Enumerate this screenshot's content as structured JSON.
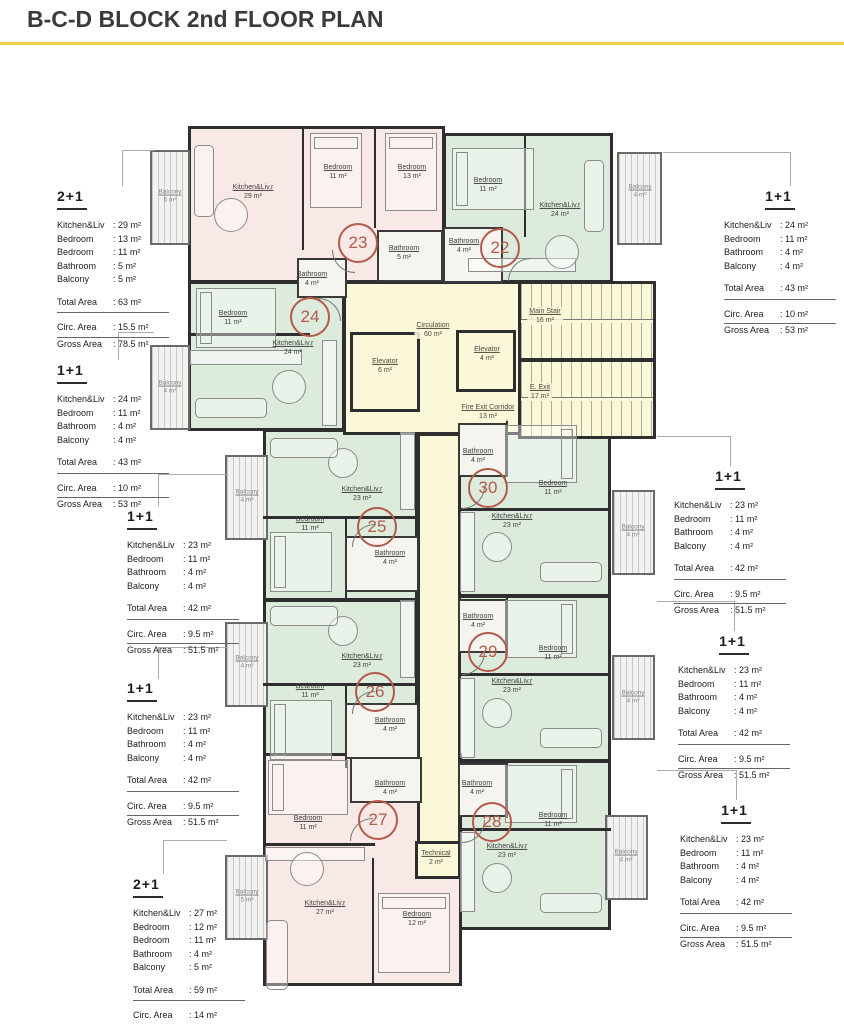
{
  "title": "B-C-D BLOCK 2nd FLOOR PLAN",
  "colors": {
    "accent_line": "#e9d44c",
    "unit_pink": "#f9e9e6",
    "unit_green": "#dcebdb",
    "core_cream": "#fbf7d9",
    "unit_number_circle": "#b45a4b",
    "wall": "#2e2e2e"
  },
  "spec_boxes": {
    "left": [
      {
        "type": "2+1",
        "items": [
          {
            "label": "Kitchen&Liv",
            "value": ": 29 m²"
          },
          {
            "label": "Bedroom",
            "value": ": 13 m²"
          },
          {
            "label": "Bedroom",
            "value": ": 11 m²"
          },
          {
            "label": "Bathroom",
            "value": ": 5 m²"
          },
          {
            "label": "Balcony",
            "value": ": 5 m²"
          }
        ],
        "total": {
          "label": "Total Area",
          "value": ": 63 m²"
        },
        "circ": {
          "label": "Circ. Area",
          "value": ": 15.5 m²"
        },
        "gross": {
          "label": "Gross Area",
          "value": ": 78.5 m²"
        }
      },
      {
        "type": "1+1",
        "items": [
          {
            "label": "Kitchen&Liv",
            "value": ": 24 m²"
          },
          {
            "label": "Bedroom",
            "value": ": 11 m²"
          },
          {
            "label": "Bathroom",
            "value": ": 4 m²"
          },
          {
            "label": "Balcony",
            "value": ": 4 m²"
          }
        ],
        "total": {
          "label": "Total Area",
          "value": ": 43 m²"
        },
        "circ": {
          "label": "Circ. Area",
          "value": ": 10 m²"
        },
        "gross": {
          "label": "Gross Area",
          "value": ": 53 m²"
        }
      },
      {
        "type": "1+1",
        "items": [
          {
            "label": "Kitchen&Liv",
            "value": ": 23 m²"
          },
          {
            "label": "Bedroom",
            "value": ": 11 m²"
          },
          {
            "label": "Bathroom",
            "value": ": 4 m²"
          },
          {
            "label": "Balcony",
            "value": ": 4 m²"
          }
        ],
        "total": {
          "label": "Total Area",
          "value": ": 42 m²"
        },
        "circ": {
          "label": "Circ. Area",
          "value": ": 9.5 m²"
        },
        "gross": {
          "label": "Gross Area",
          "value": ": 51.5 m²"
        }
      },
      {
        "type": "1+1",
        "items": [
          {
            "label": "Kitchen&Liv",
            "value": ": 23 m²"
          },
          {
            "label": "Bedroom",
            "value": ": 11 m²"
          },
          {
            "label": "Bathroom",
            "value": ": 4 m²"
          },
          {
            "label": "Balcony",
            "value": ": 4 m²"
          }
        ],
        "total": {
          "label": "Total Area",
          "value": ": 42 m²"
        },
        "circ": {
          "label": "Circ. Area",
          "value": ": 9.5 m²"
        },
        "gross": {
          "label": "Gross Area",
          "value": ": 51.5 m²"
        }
      },
      {
        "type": "2+1",
        "items": [
          {
            "label": "Kitchen&Liv",
            "value": ": 27 m²"
          },
          {
            "label": "Bedroom",
            "value": ": 12 m²"
          },
          {
            "label": "Bedroom",
            "value": ": 11 m²"
          },
          {
            "label": "Bathroom",
            "value": ": 4 m²"
          },
          {
            "label": "Balcony",
            "value": ": 5 m²"
          }
        ],
        "total": {
          "label": "Total Area",
          "value": ": 59 m²"
        },
        "circ": {
          "label": "Circ. Area",
          "value": ": 14 m²"
        },
        "gross": {
          "label": "Gross Area",
          "value": ": 73 m²"
        }
      }
    ],
    "right": [
      {
        "type": "1+1",
        "items": [
          {
            "label": "Kitchen&Liv",
            "value": ": 24 m²"
          },
          {
            "label": "Bedroom",
            "value": ": 11 m²"
          },
          {
            "label": "Bathroom",
            "value": ": 4 m²"
          },
          {
            "label": "Balcony",
            "value": ": 4 m²"
          }
        ],
        "total": {
          "label": "Total Area",
          "value": ": 43 m²"
        },
        "circ": {
          "label": "Circ. Area",
          "value": ": 10 m²"
        },
        "gross": {
          "label": "Gross Area",
          "value": ": 53 m²"
        }
      },
      {
        "type": "1+1",
        "items": [
          {
            "label": "Kitchen&Liv",
            "value": ": 23 m²"
          },
          {
            "label": "Bedroom",
            "value": ": 11 m²"
          },
          {
            "label": "Bathroom",
            "value": ": 4 m²"
          },
          {
            "label": "Balcony",
            "value": ": 4 m²"
          }
        ],
        "total": {
          "label": "Total Area",
          "value": ": 42 m²"
        },
        "circ": {
          "label": "Circ. Area",
          "value": ": 9.5 m²"
        },
        "gross": {
          "label": "Gross Area",
          "value": ": 51.5 m²"
        }
      },
      {
        "type": "1+1",
        "items": [
          {
            "label": "Kitchen&Liv",
            "value": ": 23 m²"
          },
          {
            "label": "Bedroom",
            "value": ": 11 m²"
          },
          {
            "label": "Bathroom",
            "value": ": 4 m²"
          },
          {
            "label": "Balcony",
            "value": ": 4 m²"
          }
        ],
        "total": {
          "label": "Total Area",
          "value": ": 42 m²"
        },
        "circ": {
          "label": "Circ. Area",
          "value": ": 9.5 m²"
        },
        "gross": {
          "label": "Gross Area",
          "value": ": 51.5 m²"
        }
      },
      {
        "type": "1+1",
        "items": [
          {
            "label": "Kitchen&Liv",
            "value": ": 23 m²"
          },
          {
            "label": "Bedroom",
            "value": ": 11 m²"
          },
          {
            "label": "Bathroom",
            "value": ": 4 m²"
          },
          {
            "label": "Balcony",
            "value": ": 4 m²"
          }
        ],
        "total": {
          "label": "Total Area",
          "value": ": 42 m²"
        },
        "circ": {
          "label": "Circ. Area",
          "value": ": 9.5 m²"
        },
        "gross": {
          "label": "Gross Area",
          "value": ": 51.5 m²"
        }
      }
    ]
  },
  "plan": {
    "units": [
      "22",
      "23",
      "24",
      "25",
      "26",
      "27",
      "28",
      "29",
      "30"
    ],
    "rooms": [
      {
        "name": "Kitchen&Liv.r",
        "area": "29 m²"
      },
      {
        "name": "Bedroom",
        "area": "11 m²"
      },
      {
        "name": "Bedroom",
        "area": "13 m²"
      },
      {
        "name": "Bathroom",
        "area": "5 m²"
      },
      {
        "name": "Bedroom",
        "area": "11 m²"
      },
      {
        "name": "Kitchen&Liv.r",
        "area": "24 m²"
      },
      {
        "name": "Bathroom",
        "area": "4 m²"
      },
      {
        "name": "Bedroom",
        "area": "11 m²"
      },
      {
        "name": "Bathroom",
        "area": "4 m²"
      },
      {
        "name": "Kitchen&Liv.r",
        "area": "24 m²"
      },
      {
        "name": "Kitchen&Liv.r",
        "area": "23 m²"
      },
      {
        "name": "Bedroom",
        "area": "11 m²"
      },
      {
        "name": "Bathroom",
        "area": "4 m²"
      },
      {
        "name": "Kitchen&Liv.r",
        "area": "23 m²"
      },
      {
        "name": "Bedroom",
        "area": "11 m²"
      },
      {
        "name": "Bathroom",
        "area": "4 m²"
      },
      {
        "name": "Bathroom",
        "area": "4 m²"
      },
      {
        "name": "Bedroom",
        "area": "11 m²"
      },
      {
        "name": "Kitchen&Liv.r",
        "area": "23 m²"
      },
      {
        "name": "Bathroom",
        "area": "4 m²"
      },
      {
        "name": "Bedroom",
        "area": "11 m²"
      },
      {
        "name": "Kitchen&Liv.r",
        "area": "23 m²"
      },
      {
        "name": "Bathroom",
        "area": "4 m²"
      },
      {
        "name": "Bedroom",
        "area": "11 m²"
      },
      {
        "name": "Kitchen&Liv.r",
        "area": "23 m²"
      },
      {
        "name": "Bedroom",
        "area": "11 m²"
      },
      {
        "name": "Bathroom",
        "area": "4 m²"
      },
      {
        "name": "Kitchen&Liv.r",
        "area": "27 m²"
      },
      {
        "name": "Bedroom",
        "area": "12 m²"
      }
    ],
    "core": {
      "circulation": {
        "name": "Circulation",
        "area": "60 m²"
      },
      "elevator1": {
        "name": "Elevator",
        "area": "6 m²"
      },
      "elevator2": {
        "name": "Elevator",
        "area": "4 m²"
      },
      "main_stair": {
        "name": "Main Stair",
        "area": "16 m²"
      },
      "e_exit": {
        "name": "E. Exit",
        "area": "17 m²"
      },
      "fire_exit": {
        "name": "Fire Exit Corridor",
        "area": "13 m²"
      },
      "technical": {
        "name": "Technical",
        "area": "2 m²"
      }
    },
    "balconies": [
      {
        "name": "Balcony",
        "area": "5 m²"
      },
      {
        "name": "Balcony",
        "area": "4 m²"
      },
      {
        "name": "Balcony",
        "area": "4 m²"
      },
      {
        "name": "Balcony",
        "area": "4 m²"
      },
      {
        "name": "Balcony",
        "area": "4 m²"
      },
      {
        "name": "Balcony",
        "area": "5 m²"
      },
      {
        "name": "Balcony",
        "area": "4 m²"
      },
      {
        "name": "Balcony",
        "area": "4 m²"
      },
      {
        "name": "Balcony",
        "area": "4 m²"
      }
    ]
  }
}
